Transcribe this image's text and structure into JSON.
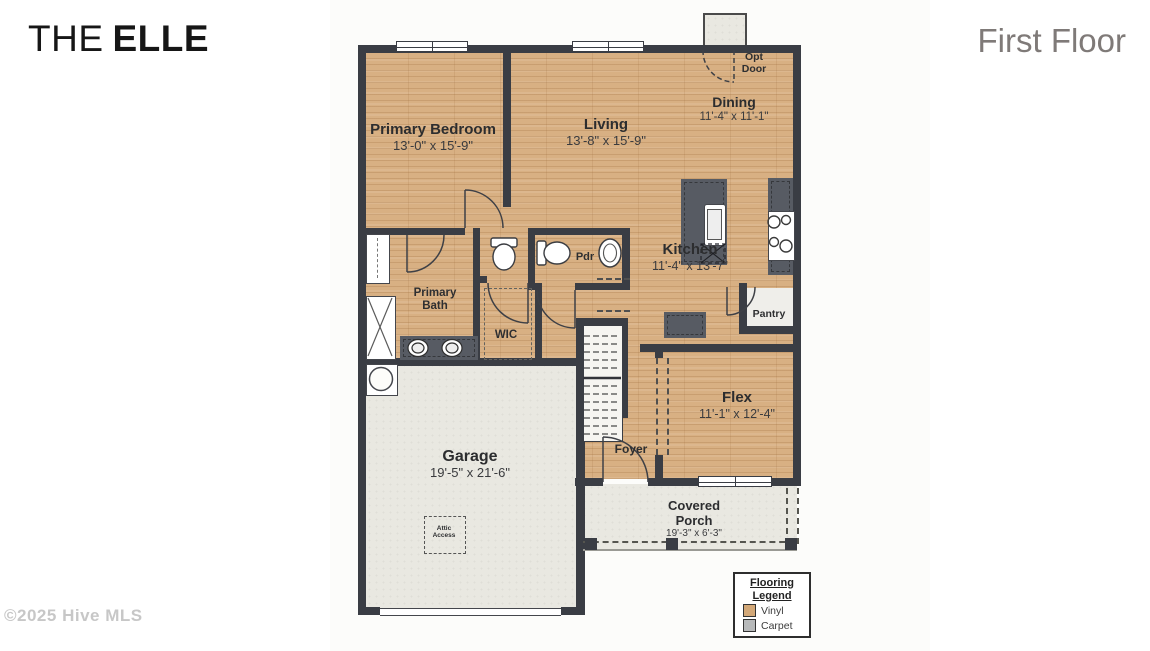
{
  "page": {
    "title_light": "THE",
    "title_bold": "ELLE",
    "floor_label": "First Floor",
    "copyright": "©2025 Hive MLS"
  },
  "rooms": {
    "primary_bedroom": {
      "name": "Primary Bedroom",
      "dims": "13'-0\" x 15'-9\""
    },
    "living": {
      "name": "Living",
      "dims": "13'-8\" x 15'-9\""
    },
    "dining": {
      "name": "Dining",
      "dims": "11'-4\" x 11'-1\""
    },
    "kitchen": {
      "name": "Kitchen",
      "dims": "11'-4\" x 13'-7\""
    },
    "flex": {
      "name": "Flex",
      "dims": "11'-1\" x 12'-4\""
    },
    "garage": {
      "name": "Garage",
      "dims": "19'-5\" x 21'-6\""
    },
    "covered_porch": {
      "name": "Covered Porch",
      "dims": "19'-3\" x 6'-3\""
    },
    "primary_bath": {
      "name": "Primary Bath"
    },
    "wic": {
      "name": "WIC"
    },
    "pdr": {
      "name": "Pdr"
    },
    "pantry": {
      "name": "Pantry"
    },
    "foyer": {
      "name": "Foyer"
    },
    "opt_door": {
      "name": "Opt Door"
    },
    "attic_access": {
      "name": "Attic Access"
    }
  },
  "legend": {
    "title": "Flooring Legend",
    "items": [
      {
        "label": "Vinyl",
        "color": "#d3a878"
      },
      {
        "label": "Carpet",
        "color": "#b7b9ba"
      }
    ]
  },
  "colors": {
    "wall": "#3a3d44",
    "vinyl_floor": "#d8b083",
    "concrete_floor": "#e9e8e1",
    "counter": "#575b63"
  }
}
